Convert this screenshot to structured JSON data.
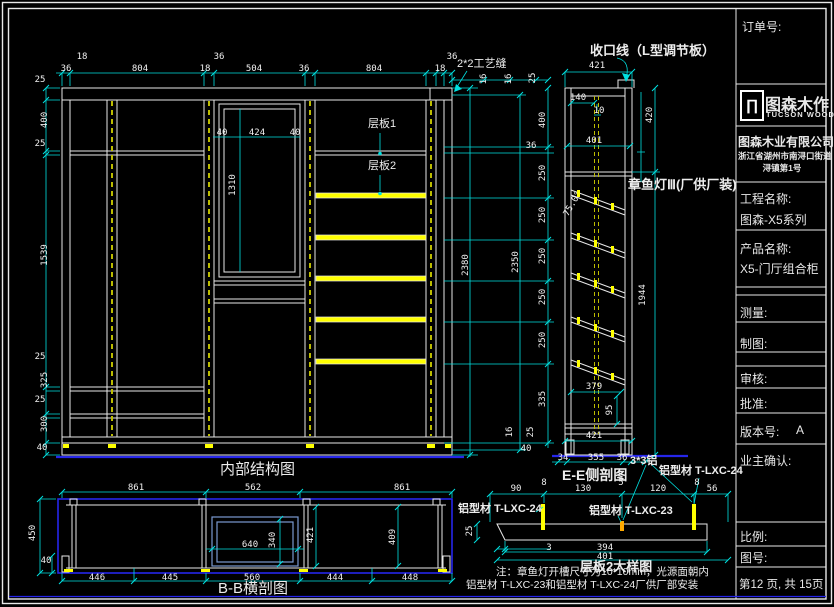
{
  "views": {
    "front": {
      "title": "内部结构图"
    },
    "side": {
      "title": "E-E侧剖图"
    },
    "section": {
      "title": "B-B横剖图"
    },
    "detail": {
      "title": "层板2大样图"
    }
  },
  "labels": {
    "trim": "收口线（L型调节板）",
    "seam": "2*2工艺缝",
    "lamp": "章鱼灯Ⅲ(厂供厂装)",
    "shelf1": "层板1",
    "shelf2": "层板2",
    "alu33": "3*3铝",
    "alu24_left": "铝型材 T-LXC-24",
    "alu24_right": "铝型材 T-LXC-24",
    "alu23": "铝型材 T-LXC-23"
  },
  "notes": {
    "line1": "注：章鱼灯开槽尺寸为10*10mm，光源面朝内",
    "line2": "铝型材 T-LXC-23和铝型材 T-LXC-24厂供厂部安装"
  },
  "title_block": {
    "order_label": "订单号:",
    "logo_glyph": "∏",
    "logo_text": "图森木作",
    "logo_sub": "TUCSON WOOD",
    "company": "图森木业有限公司",
    "address_line1": "浙江省湖州市南浔口街道",
    "address_line2": "浔镇第1号",
    "project_label": "工程名称:",
    "project_value": "图森-X5系列",
    "product_label": "产品名称:",
    "product_value": "X5-门厅组合柜",
    "measure_label": "测量:",
    "draft_label": "制图:",
    "review_label": "审核:",
    "approve_label": "批准:",
    "version_label": "版本号:",
    "version_value": "A",
    "owner_label": "业主确认:",
    "scale_label": "比例:",
    "drawing_no_label": "图号:",
    "page_info": "第12 页, 共 15页"
  },
  "colors": {
    "dimension": "#00e0e0",
    "linework": "#e8e8e8",
    "highlight": "#ffff00",
    "floor": "#2626ea",
    "section_box": "#7a9ad0"
  },
  "dimensions": [
    {
      "t": "18",
      "x": 82,
      "y": 57
    },
    {
      "t": "36",
      "x": 66,
      "y": 69
    },
    {
      "t": "804",
      "x": 140,
      "y": 69
    },
    {
      "t": "18",
      "x": 205,
      "y": 69
    },
    {
      "t": "36",
      "x": 219,
      "y": 57
    },
    {
      "t": "504",
      "x": 254,
      "y": 69
    },
    {
      "t": "36",
      "x": 304,
      "y": 69
    },
    {
      "t": "804",
      "x": 374,
      "y": 69
    },
    {
      "t": "18",
      "x": 440,
      "y": 69
    },
    {
      "t": "36",
      "x": 452,
      "y": 57
    },
    {
      "t": "25",
      "x": 40,
      "y": 80
    },
    {
      "t": "400",
      "x": 45,
      "y": 120,
      "r": -90
    },
    {
      "t": "25",
      "x": 40,
      "y": 144
    },
    {
      "t": "1539",
      "x": 45,
      "y": 255,
      "r": -90
    },
    {
      "t": "25",
      "x": 40,
      "y": 357
    },
    {
      "t": "325",
      "x": 45,
      "y": 380,
      "r": -90
    },
    {
      "t": "25",
      "x": 40,
      "y": 400
    },
    {
      "t": "300",
      "x": 45,
      "y": 424,
      "r": -90
    },
    {
      "t": "40",
      "x": 42,
      "y": 448
    },
    {
      "t": "40",
      "x": 222,
      "y": 133
    },
    {
      "t": "424",
      "x": 257,
      "y": 133
    },
    {
      "t": "40",
      "x": 295,
      "y": 133
    },
    {
      "t": "1310",
      "x": 233,
      "y": 185,
      "r": -90
    },
    {
      "t": "2380",
      "x": 466,
      "y": 265,
      "r": -90
    },
    {
      "t": "2350",
      "x": 516,
      "y": 262,
      "r": -90
    },
    {
      "t": "16",
      "x": 484,
      "y": 79,
      "r": -90
    },
    {
      "t": "16",
      "x": 509,
      "y": 79,
      "r": -90
    },
    {
      "t": "25",
      "x": 533,
      "y": 78,
      "r": -90
    },
    {
      "t": "400",
      "x": 543,
      "y": 120,
      "r": -90
    },
    {
      "t": "36",
      "x": 531,
      "y": 146
    },
    {
      "t": "250",
      "x": 543,
      "y": 173,
      "r": -90
    },
    {
      "t": "250",
      "x": 543,
      "y": 215,
      "r": -90
    },
    {
      "t": "250",
      "x": 543,
      "y": 256,
      "r": -90
    },
    {
      "t": "250",
      "x": 543,
      "y": 297,
      "r": -90
    },
    {
      "t": "250",
      "x": 543,
      "y": 340,
      "r": -90
    },
    {
      "t": "335",
      "x": 543,
      "y": 399,
      "r": -90
    },
    {
      "t": "16",
      "x": 510,
      "y": 432,
      "r": -90
    },
    {
      "t": "25",
      "x": 531,
      "y": 432,
      "r": -90
    },
    {
      "t": "40",
      "x": 526,
      "y": 449
    },
    {
      "t": "421",
      "x": 597,
      "y": 66
    },
    {
      "t": "140",
      "x": 578,
      "y": 98
    },
    {
      "t": "10",
      "x": 599,
      "y": 111
    },
    {
      "t": "401",
      "x": 594,
      "y": 141
    },
    {
      "t": "75.0°",
      "x": 573,
      "y": 204,
      "r": -60
    },
    {
      "t": "420",
      "x": 650,
      "y": 115,
      "r": -90
    },
    {
      "t": "1944",
      "x": 643,
      "y": 295,
      "r": -90
    },
    {
      "t": "379",
      "x": 594,
      "y": 387
    },
    {
      "t": "95",
      "x": 610,
      "y": 410,
      "r": -90
    },
    {
      "t": "421",
      "x": 594,
      "y": 436
    },
    {
      "t": "34",
      "x": 563,
      "y": 458
    },
    {
      "t": "355",
      "x": 596,
      "y": 458
    },
    {
      "t": "36",
      "x": 622,
      "y": 458
    },
    {
      "t": "861",
      "x": 136,
      "y": 488
    },
    {
      "t": "562",
      "x": 253,
      "y": 488
    },
    {
      "t": "861",
      "x": 402,
      "y": 488
    },
    {
      "t": "450",
      "x": 33,
      "y": 533,
      "r": -90
    },
    {
      "t": "40",
      "x": 46,
      "y": 561
    },
    {
      "t": "640",
      "x": 250,
      "y": 545
    },
    {
      "t": "340",
      "x": 273,
      "y": 540,
      "r": -90
    },
    {
      "t": "421",
      "x": 311,
      "y": 535,
      "r": -90
    },
    {
      "t": "409",
      "x": 393,
      "y": 537,
      "r": -90
    },
    {
      "t": "446",
      "x": 97,
      "y": 578
    },
    {
      "t": "445",
      "x": 170,
      "y": 578
    },
    {
      "t": "560",
      "x": 252,
      "y": 578
    },
    {
      "t": "444",
      "x": 335,
      "y": 578
    },
    {
      "t": "448",
      "x": 410,
      "y": 578
    },
    {
      "t": "90",
      "x": 516,
      "y": 489
    },
    {
      "t": "8",
      "x": 544,
      "y": 483
    },
    {
      "t": "130",
      "x": 583,
      "y": 489
    },
    {
      "t": "5",
      "x": 621,
      "y": 483
    },
    {
      "t": "120",
      "x": 658,
      "y": 489
    },
    {
      "t": "8",
      "x": 697,
      "y": 483
    },
    {
      "t": "56",
      "x": 712,
      "y": 489
    },
    {
      "t": "25",
      "x": 470,
      "y": 531,
      "r": -90
    },
    {
      "t": "3",
      "x": 549,
      "y": 548
    },
    {
      "t": "394",
      "x": 605,
      "y": 548
    },
    {
      "t": "401",
      "x": 605,
      "y": 557
    }
  ]
}
